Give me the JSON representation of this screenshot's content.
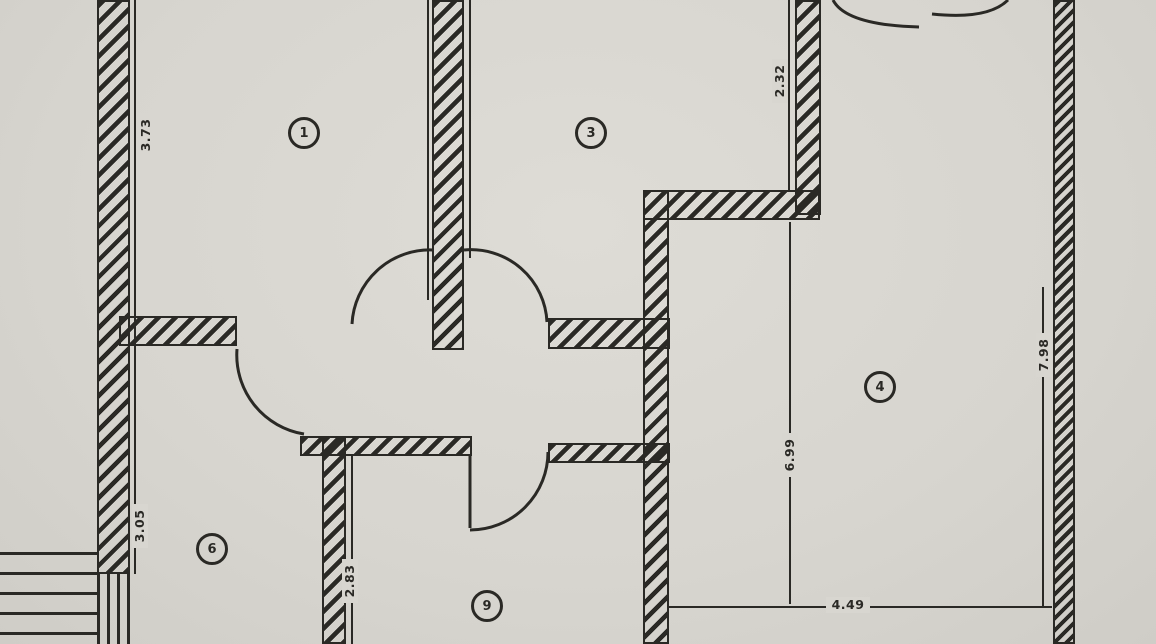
{
  "diagram": {
    "kind": "architectural-floor-plan",
    "style": "scanned blueprint, hatched walls, door swing arcs"
  },
  "colors": {
    "paper": "#d8d6d0",
    "ink": "#2a2925"
  },
  "rooms": [
    {
      "id": "room-1",
      "label": "1"
    },
    {
      "id": "room-3",
      "label": "3"
    },
    {
      "id": "room-4",
      "label": "4"
    },
    {
      "id": "room-6",
      "label": "6"
    },
    {
      "id": "room-9",
      "label": "9"
    }
  ],
  "dimensions": [
    {
      "id": "left-upper",
      "value": "3.73",
      "orientation": "vertical"
    },
    {
      "id": "left-lower",
      "value": "3.05",
      "orientation": "vertical"
    },
    {
      "id": "top-right",
      "value": "2.32",
      "orientation": "vertical"
    },
    {
      "id": "center-vertical",
      "value": "6.99",
      "orientation": "vertical"
    },
    {
      "id": "right-wall",
      "value": "7.98",
      "orientation": "vertical"
    },
    {
      "id": "room9-left",
      "value": "2.83",
      "orientation": "vertical"
    },
    {
      "id": "bottom-horizontal",
      "value": "4.49",
      "orientation": "horizontal"
    }
  ]
}
